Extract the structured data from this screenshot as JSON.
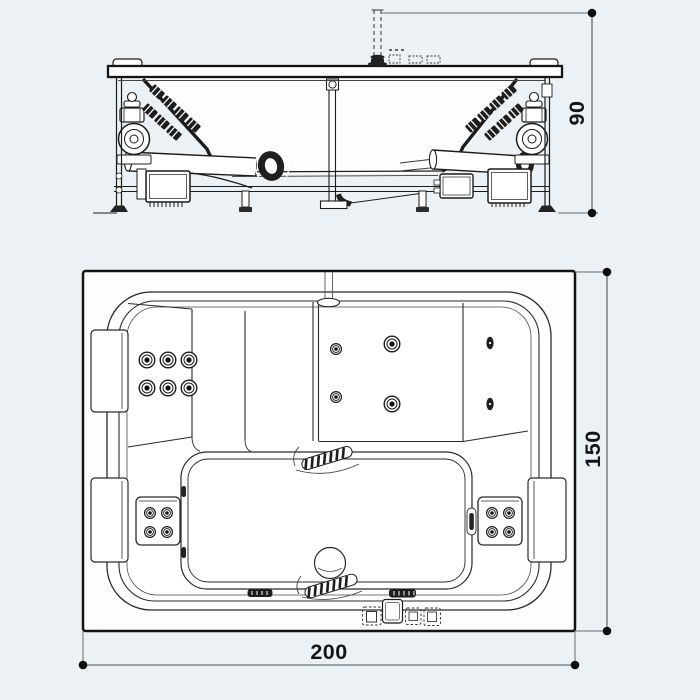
{
  "dimensions": {
    "height": "90",
    "depth": "150",
    "width": "200"
  },
  "colors": {
    "background": "#ECF1F5",
    "paper": "#FFFFFF",
    "line": "#1C1C1C",
    "dimension_line": "#6A6A6A",
    "dimension_marker": "#0D0D0D"
  }
}
